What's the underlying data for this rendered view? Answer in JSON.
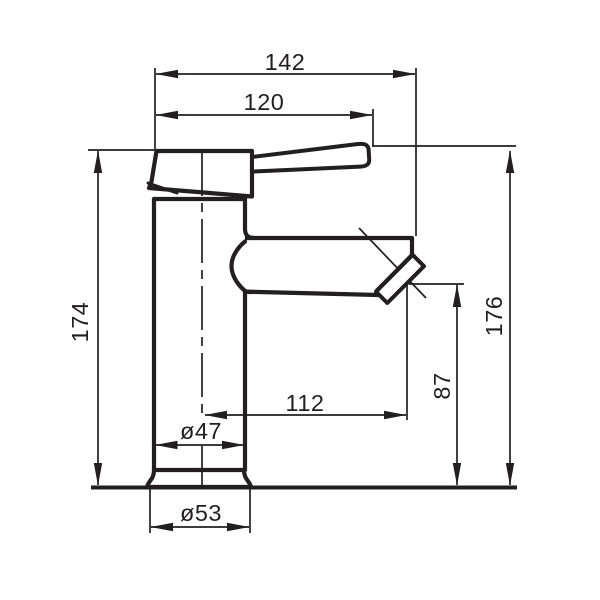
{
  "drawing": {
    "type": "technical-dimension-drawing",
    "subject": "single-lever basin mixer tap, side view",
    "dimensions": {
      "total_projection": "142",
      "handle_projection": "120",
      "spout_reach": "112",
      "height_left": "174",
      "height_right": "176",
      "outlet_height": "87",
      "body_diameter": "ø47",
      "base_diameter": "ø53"
    },
    "colors": {
      "line": "#231f20",
      "background": "#ffffff"
    }
  }
}
